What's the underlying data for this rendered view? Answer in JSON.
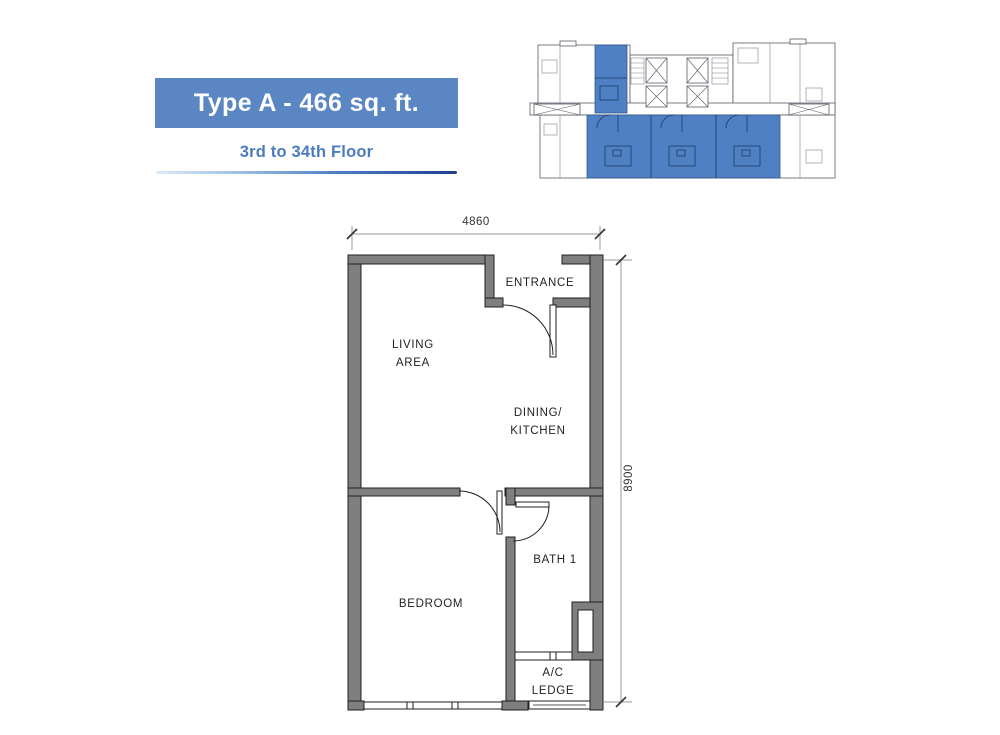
{
  "title": {
    "type_label": "Type A - 466 sq. ft.",
    "floor_range": "3rd to 34th Floor"
  },
  "colors": {
    "accent_blue": "#5b86c4",
    "subtitle_blue": "#4b7cc1",
    "keyplan_highlight_blue": "#4e80c3",
    "wall_gray": "#7f7f7f"
  },
  "floorplan": {
    "rooms": {
      "entrance": "ENTRANCE",
      "living_area": "LIVING\nAREA",
      "dining_kitchen": "DINING/\nKITCHEN",
      "bedroom": "BEDROOM",
      "bath": "BATH 1",
      "ac_ledge": "A/C\nLEDGE"
    },
    "dimensions": {
      "width_mm": "4860",
      "height_mm": "8900"
    }
  }
}
